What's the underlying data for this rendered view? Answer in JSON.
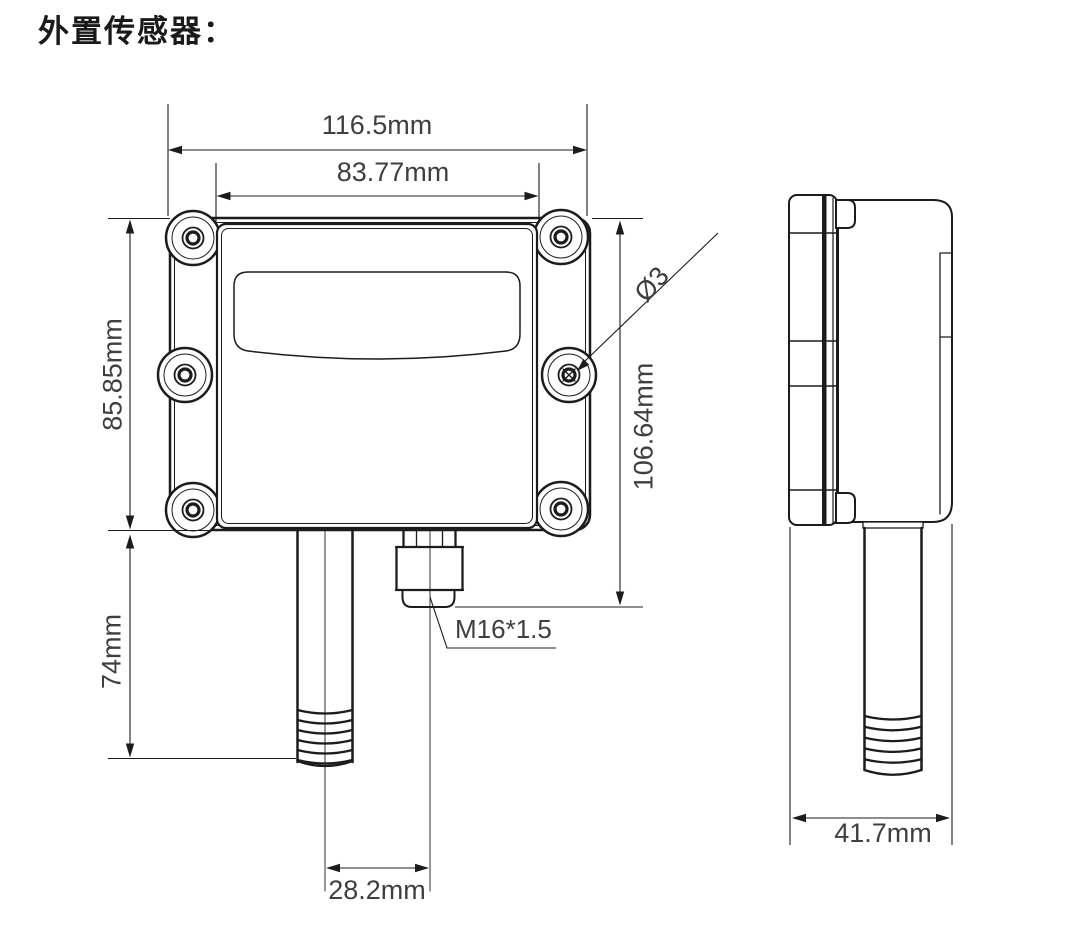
{
  "title": "外置传感器：",
  "colors": {
    "line": "#1c1c1c",
    "text": "#3f3f3f",
    "background": "#ffffff"
  },
  "front_view": {
    "label": "front-view",
    "dimensions": {
      "overall_width": "116.5mm",
      "inner_width": "83.77mm",
      "body_height": "85.85mm",
      "probe_length": "74mm",
      "overall_height": "106.64mm",
      "mounting_hole_diameter": "Ø3",
      "cable_gland_thread": "M16*1.5",
      "probe_center_offset": "28.2mm"
    }
  },
  "side_view": {
    "label": "side-view",
    "dimensions": {
      "depth": "41.7mm"
    }
  }
}
